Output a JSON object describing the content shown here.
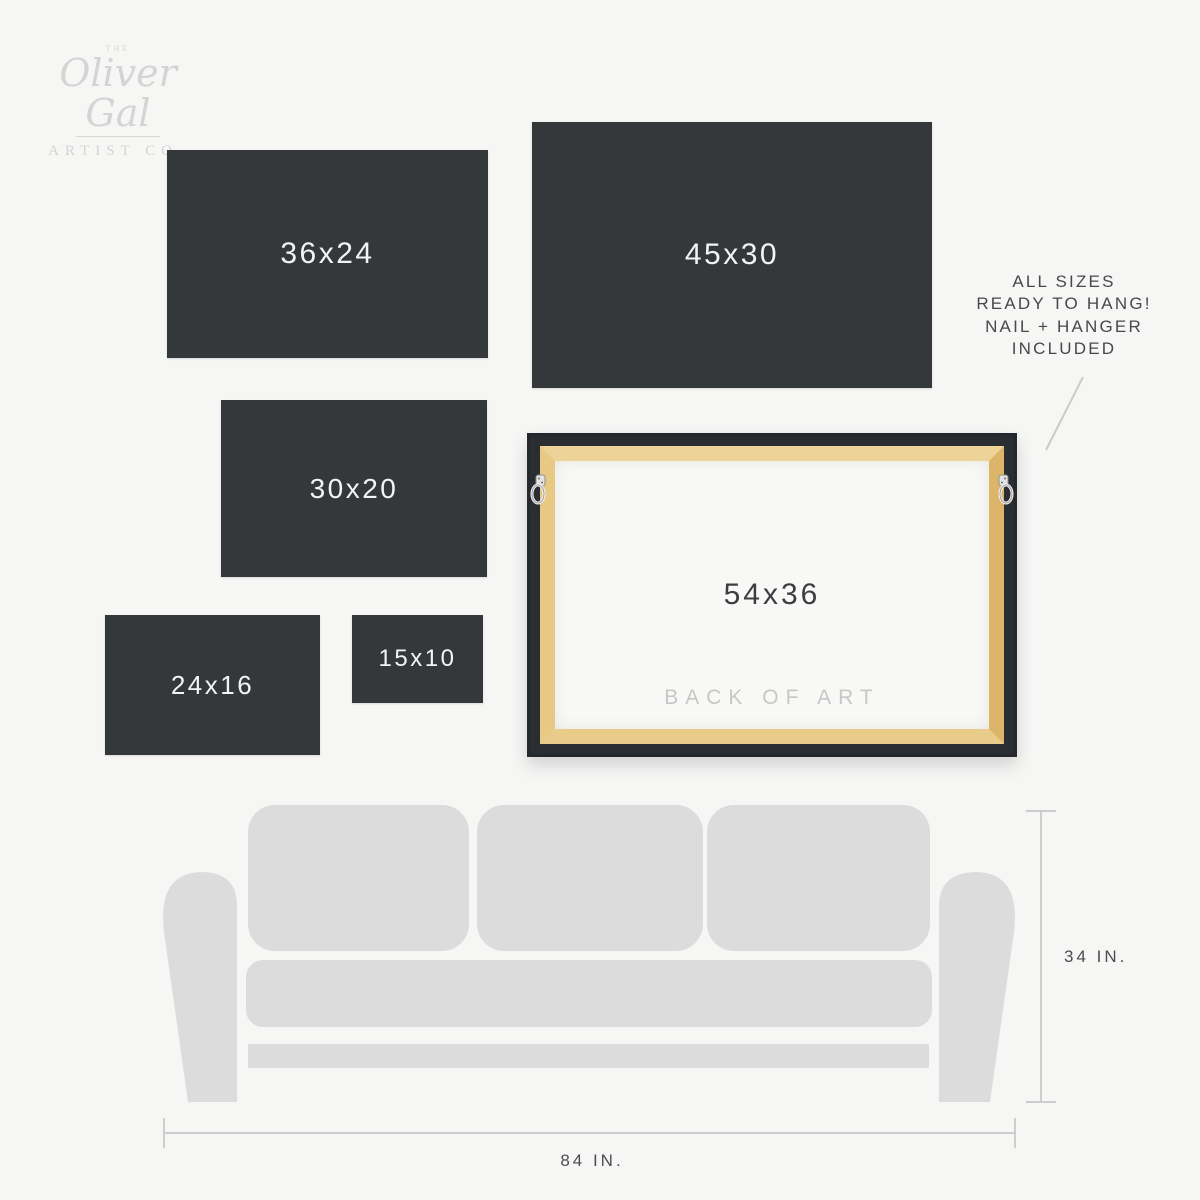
{
  "logo": {
    "the": "THE",
    "name": "Oliver Gal",
    "subtitle": "ARTIST CO."
  },
  "size_boxes": [
    {
      "label": "36x24"
    },
    {
      "label": "45x30"
    },
    {
      "label": "30x20"
    },
    {
      "label": "24x16"
    },
    {
      "label": "15x10"
    }
  ],
  "frame": {
    "size_label": "54x36",
    "back_label": "BACK OF ART"
  },
  "annotation": {
    "line1": "ALL SIZES",
    "line2": "READY TO HANG!",
    "line3": "NAIL + HANGER",
    "line4": "INCLUDED"
  },
  "dimensions": {
    "sofa_height": "34 IN.",
    "sofa_width": "84 IN."
  },
  "colors": {
    "background": "#f6f6f5",
    "panel_dark": "#35383b",
    "panel_label": "#f3f3f4",
    "sofa_gray": "#dcdcdc",
    "dimension_line": "#cdcdcd",
    "annotation_text": "#45494e",
    "frame_black": "#2a2d31",
    "wood_tan": "#e6c57f",
    "back_label_gray": "#c7c7c7",
    "logo_gray": "#d4d4d4"
  }
}
